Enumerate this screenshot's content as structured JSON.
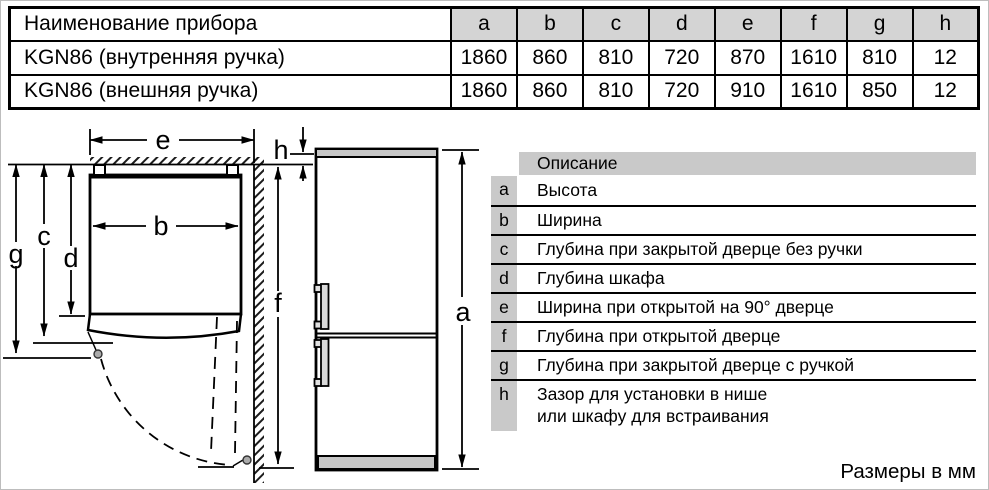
{
  "spec_table": {
    "name_header": "Наименование прибора",
    "dim_headers": [
      "a",
      "b",
      "c",
      "d",
      "e",
      "f",
      "g",
      "h"
    ],
    "rows": [
      {
        "name": "KGN86 (внутренняя ручка)",
        "values": [
          "1860",
          "860",
          "810",
          "720",
          "870",
          "1610",
          "810",
          "12"
        ]
      },
      {
        "name": "KGN86 (внешняя ручка)",
        "values": [
          "1860",
          "860",
          "810",
          "720",
          "910",
          "1610",
          "850",
          "12"
        ]
      }
    ]
  },
  "legend": {
    "header": "Описание",
    "items": [
      {
        "key": "a",
        "text": "Высота"
      },
      {
        "key": "b",
        "text": "Ширина"
      },
      {
        "key": "c",
        "text": "Глубина при закрытой дверце без ручки"
      },
      {
        "key": "d",
        "text": "Глубина шкафа"
      },
      {
        "key": "e",
        "text": "Ширина при открытой на 90° дверце"
      },
      {
        "key": "f",
        "text": "Глубина при открытой дверце"
      },
      {
        "key": "g",
        "text": "Глубина при закрытой дверце с ручкой"
      },
      {
        "key": "h",
        "text": "Зазор для установки в нише",
        "text2": "или шкафу для встраивания"
      }
    ]
  },
  "diagram": {
    "labels": {
      "a": "a",
      "b": "b",
      "c": "c",
      "d": "d",
      "e": "e",
      "f": "f",
      "g": "g",
      "h": "h"
    }
  },
  "footer": {
    "units_note": "Размеры в мм"
  },
  "colors": {
    "table_header_bg": "#d4d4d4",
    "legend_key_bg": "#c9c9c9",
    "appliance_gray": "#c6c6c6",
    "line": "#000000"
  }
}
